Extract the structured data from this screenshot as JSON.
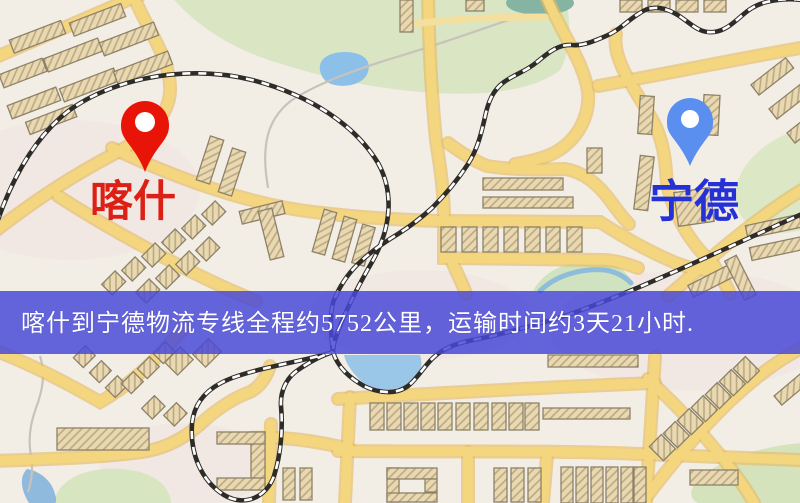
{
  "map": {
    "origin": {
      "name": "喀什",
      "pin_color": "#e81408",
      "label_color": "#dd2015"
    },
    "destination": {
      "name": "宁德",
      "pin_color": "#5a8ff0",
      "label_color": "#2431d6"
    },
    "banner": {
      "text": "喀什到宁德物流专线全程约5752公里，运输时间约3天21小时.",
      "bg_color": "rgba(72,72,216,0.84)",
      "text_color": "#ffffff"
    },
    "palette": {
      "background": "#f3eee5",
      "road_fill": "#f4d67e",
      "road_casing": "#e5bb66",
      "railway_dark": "#2e2c29",
      "railway_dash": "#ffffff",
      "park_green": "#d9e5c3",
      "water_blue": "#92c1e8",
      "building_fill": "#ead9b0",
      "building_outline": "#8d8168"
    }
  }
}
